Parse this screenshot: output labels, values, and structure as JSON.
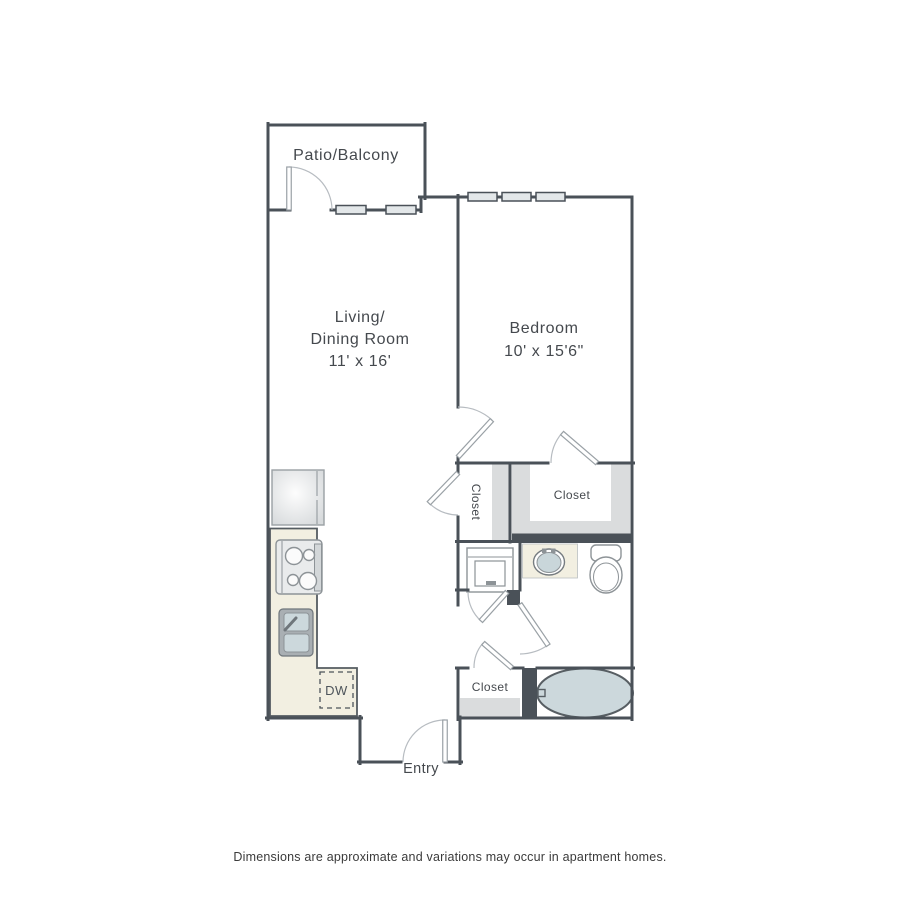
{
  "rooms": {
    "patio": {
      "label": "Patio/Balcony"
    },
    "living_dining": {
      "line1": "Living/",
      "line2": "Dining Room",
      "dims": "11' x 16'"
    },
    "bedroom": {
      "name": "Bedroom",
      "dims": "10' x 15'6\""
    },
    "bedroom_closet": {
      "label": "Closet"
    },
    "hall_closet": {
      "label": "Closet"
    },
    "entry_closet": {
      "label": "Closet"
    },
    "entry": {
      "label": "Entry"
    }
  },
  "appliances": {
    "dishwasher_label": "DW"
  },
  "footer": {
    "disclaimer": "Dimensions are approximate and variations may occur in apartment homes."
  },
  "colors": {
    "wall": "#4a5158",
    "counter": "#f2efe1",
    "closet_shading": "#dadcdd",
    "water_fixture": "#ccd8dc",
    "window_fill": "#e3e7e9",
    "label_text": "#45494e"
  }
}
